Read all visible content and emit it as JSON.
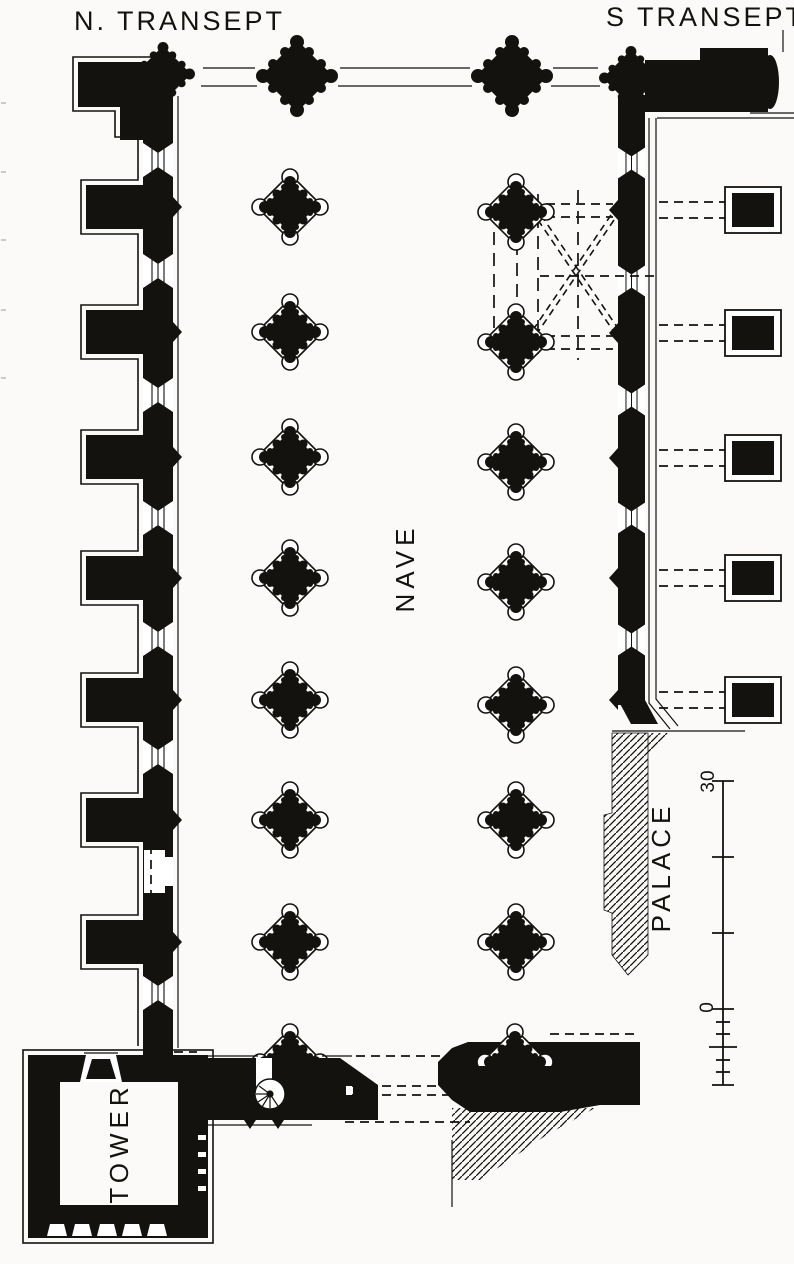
{
  "colors": {
    "paper": "#fbfaf8",
    "ink": "#14120f"
  },
  "header": {
    "north_transept": "N. TRANSEPT",
    "south_transept": "S TRANSEPT"
  },
  "rooms": {
    "nave": "NAVE",
    "palace": "PALACE",
    "tower": "TOWER"
  },
  "scale_bar": {
    "max_label": "30",
    "zero_label": "0"
  }
}
